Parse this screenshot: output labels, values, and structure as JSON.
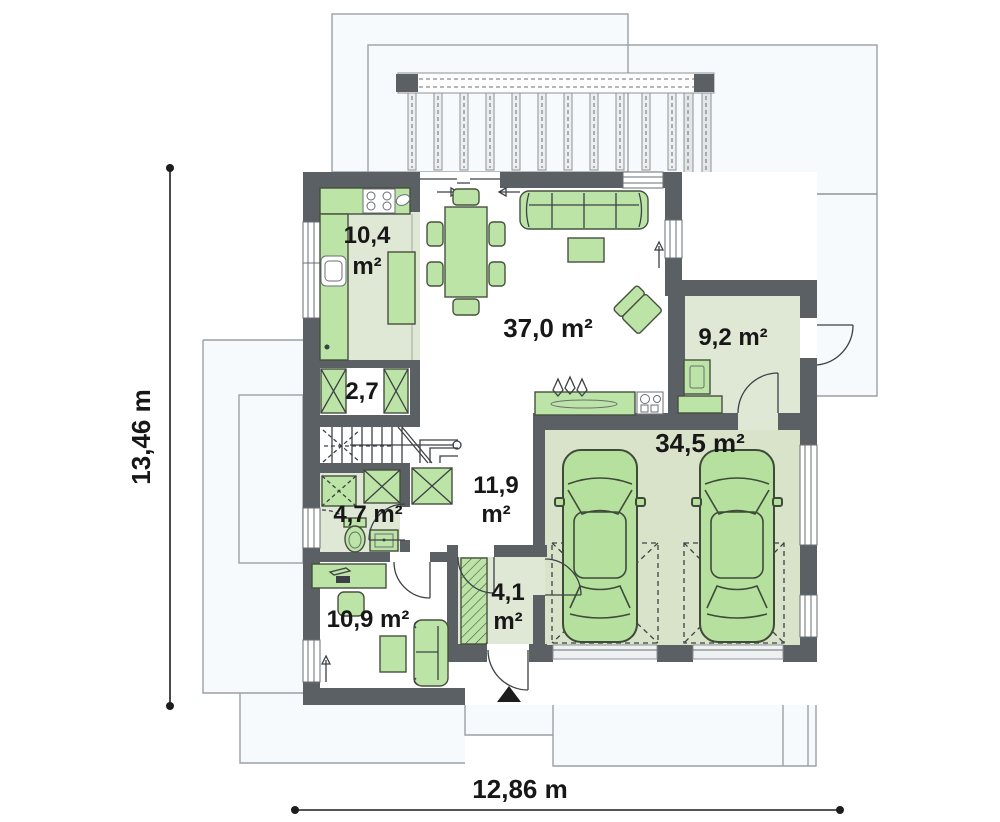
{
  "plan_title": "ground-floor-plan",
  "rooms": [
    {
      "id": "kitchen",
      "lines": [
        "10,4",
        "m²"
      ]
    },
    {
      "id": "closet",
      "lines": [
        "2,7"
      ]
    },
    {
      "id": "living",
      "lines": [
        "37,0 m²"
      ]
    },
    {
      "id": "utility",
      "lines": [
        "9,2 m²"
      ]
    },
    {
      "id": "garage",
      "lines": [
        "34,5 m²"
      ]
    },
    {
      "id": "hall",
      "lines": [
        "11,9",
        "m²"
      ]
    },
    {
      "id": "bathroom",
      "lines": [
        "4,7 m²"
      ]
    },
    {
      "id": "vestibule",
      "lines": [
        "4,1",
        "m²"
      ]
    },
    {
      "id": "study",
      "lines": [
        "10,9 m²"
      ]
    }
  ],
  "dimensions": {
    "height_label": "13,46 m",
    "width_label": "12,86 m"
  },
  "icons": {
    "entrance_marker": "filled-triangle-up"
  },
  "colors": {
    "wall": "#5b6064",
    "furniture": "#bce4a6",
    "furniture_stroke": "#46503f",
    "car": "#b6e09e",
    "room_tint": "#dfe7d5",
    "garage_tint": "#d8e3ca",
    "terrace": "#f7fafc",
    "outline": "#9aa0a5",
    "text": "#171717"
  }
}
